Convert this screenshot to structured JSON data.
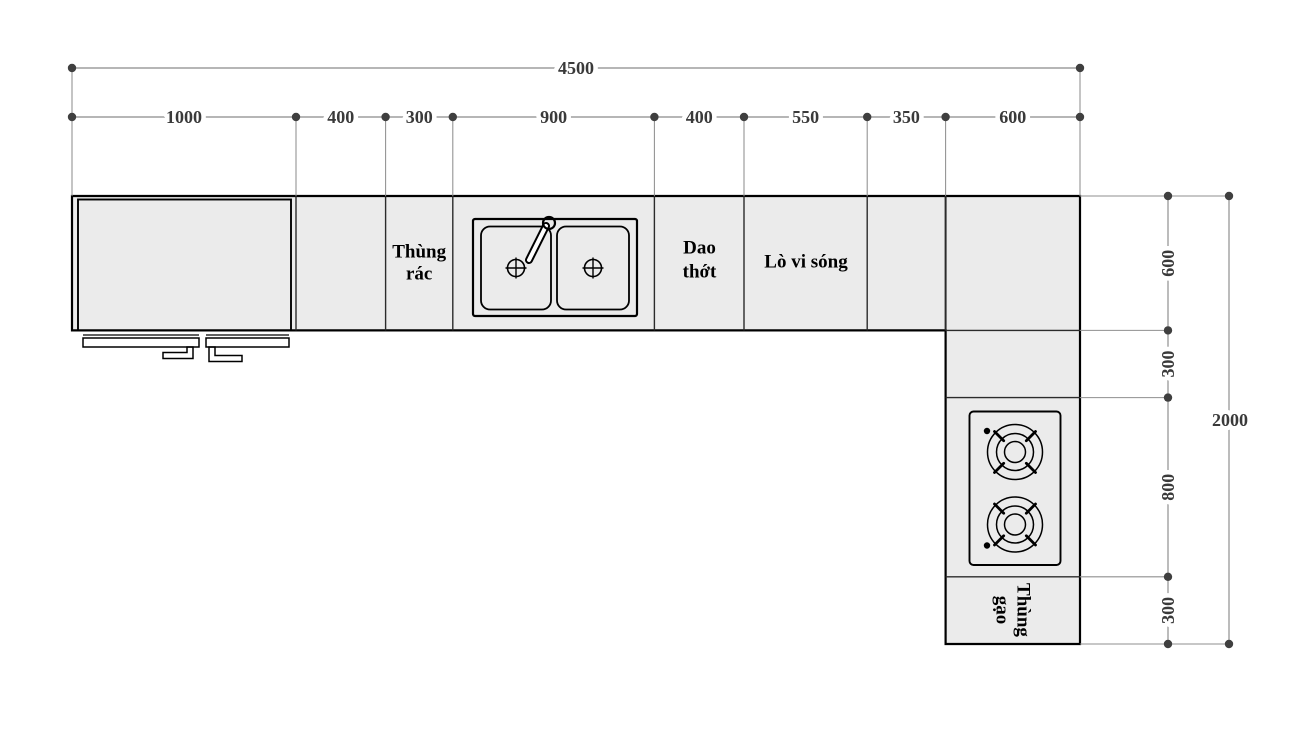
{
  "dimensions": {
    "top": {
      "total": "4500",
      "segments": [
        "1000",
        "400",
        "300",
        "900",
        "400",
        "550",
        "350",
        "600"
      ]
    },
    "right": {
      "total": "2000",
      "segments": [
        "600",
        "300",
        "800",
        "300"
      ]
    }
  },
  "labels": {
    "trash": {
      "line1": "Thùng",
      "line2": "rác"
    },
    "cutting_board": {
      "line1": "Dao",
      "line2": "thớt"
    },
    "microwave": {
      "text": "Lò vi sóng"
    },
    "rice_bin": {
      "line1": "Thùng",
      "line2": "gạo"
    }
  },
  "colors": {
    "background": "#ffffff",
    "counter_fill": "#ebebeb",
    "outline": "#000000",
    "divider": "#2b2b2b",
    "dim_line": "#8a8a8a",
    "dim_marker": "#3f3f3f",
    "dim_text": "#3a3a3a",
    "fixture_fill": "#ffffff"
  }
}
